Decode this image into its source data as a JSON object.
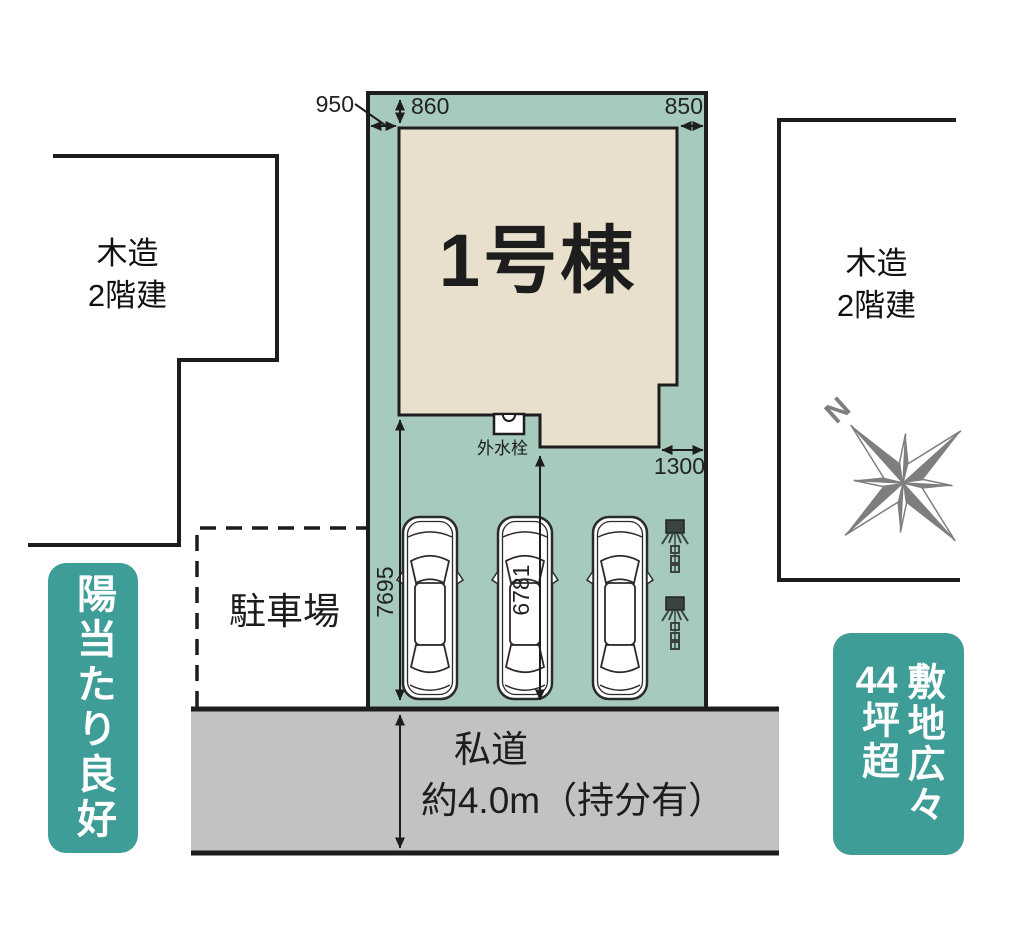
{
  "diagram": {
    "unit": {
      "label": "1号棟"
    },
    "water_tap": {
      "label": "外水栓"
    },
    "dimensions": {
      "top_left_offset": "950",
      "top_setback": "860",
      "top_right_offset": "850",
      "lower_right_offset": "1300",
      "left_depth": "7695",
      "center_depth": "6781"
    },
    "neighbor_left": {
      "label": "木造\n2階建"
    },
    "neighbor_right": {
      "label": "木造\n2階建"
    },
    "parking": {
      "label": "駐車場"
    },
    "road": {
      "line1": "私道",
      "line2": "約4.0m（持分有）"
    },
    "badge_left": {
      "text": "陽当たり良好"
    },
    "badge_right": {
      "col1": "敷地広々",
      "num": "44",
      "rest": "坪超"
    },
    "compass": {
      "north": "N"
    },
    "cars_count": 3,
    "colors": {
      "plot_fill": "#a6cabb",
      "building_fill": "#e8e0cd",
      "road_fill": "#c2c2c2",
      "badge_fill": "#3f9d98",
      "line": "#1d1d1d",
      "compass": "#7e7e7e"
    }
  }
}
